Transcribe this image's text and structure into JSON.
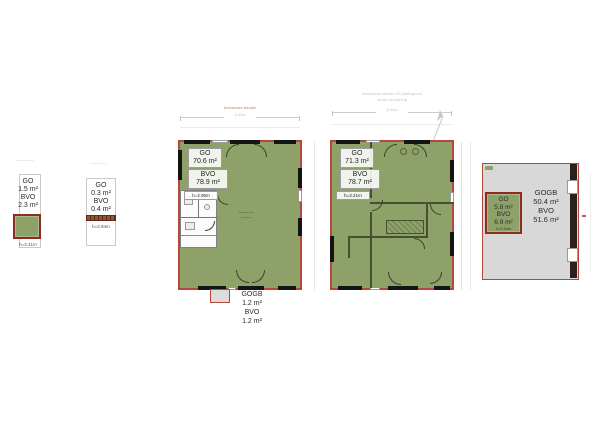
{
  "plan_a": {
    "go_label": "GO",
    "go_value": "1.5 m²",
    "bvo_label": "BVO",
    "bvo_value": "2.3 m²",
    "height_note": "h=3.41m"
  },
  "plan_b": {
    "go_label": "GO",
    "go_value": "0.3 m²",
    "bvo_label": "BVO",
    "bvo_value": "0.4 m²",
    "height_note": "h=2.94m"
  },
  "plan_c": {
    "go_label": "GO",
    "go_value": "70.6 m²",
    "bvo_label": "BVO",
    "bvo_value": "78.9 m²",
    "height_note": "h=3.06m",
    "annex": {
      "gogb_label": "GOGB",
      "gogb_value": "1.2 m²",
      "bvo_label": "BVO",
      "bvo_value": "1.2 m²"
    }
  },
  "plan_d": {
    "go_label": "GO",
    "go_value": "71.3 m²",
    "bvo_label": "BVO",
    "bvo_value": "78.7 m²",
    "height_note": "h=3.21m"
  },
  "plan_e": {
    "gogb_label": "GOGB",
    "gogb_value": "50.4 m²",
    "bvo_label": "BVO",
    "bvo_value": "51.6 m²",
    "go_box": {
      "go_label": "GO",
      "go_value": "5.8 m²",
      "bvo_label": "BVO",
      "bvo_value": "6.9 m²",
      "height_note": "h=2.64m"
    }
  },
  "fine_print": {
    "plan_c_note": "bestaande situatie",
    "plan_c_dim": "8.43m",
    "plan_d_header1": "bestaande situatie 2D plattegrond",
    "plan_d_header2": "derde verdieping",
    "plan_d_dim": "8.43m"
  },
  "colors": {
    "area_green": "#8da169",
    "outline_red": "#b5473c",
    "box_red": "#8f2b22",
    "area_gray": "#d8d8d8",
    "wall_black": "#141414"
  }
}
